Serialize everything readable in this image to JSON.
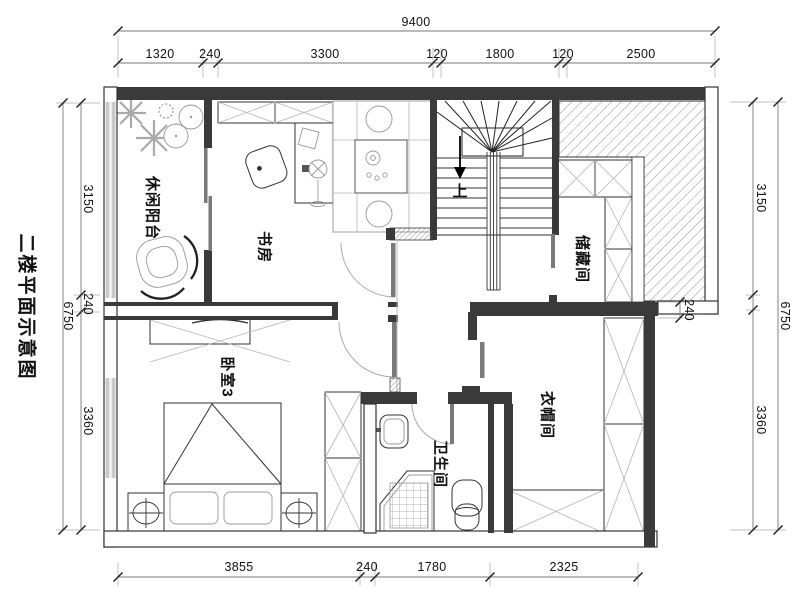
{
  "title": "二楼平面示意图",
  "rooms": {
    "balcony": "休闲阳台",
    "study": "书房",
    "storage": "储藏间",
    "bedroom": "卧室3",
    "closet": "衣帽间",
    "bathroom": "卫生间"
  },
  "stairs": {
    "direction_label": "上"
  },
  "dimensions": {
    "top_total": "9400",
    "top_segments": [
      "1320",
      "240",
      "3300",
      "120",
      "1800",
      "120",
      "2500"
    ],
    "left_total": "6750",
    "left_segments": [
      "3150",
      "240",
      "3360"
    ],
    "right_total": "6750",
    "right_segments": [
      "3150",
      "3360"
    ],
    "wall_thickness": "240",
    "bottom_segments": [
      "3855",
      "240",
      "1780",
      "2325"
    ]
  },
  "colors": {
    "wall": "#3a3a3a",
    "hatch": "#9a9a9a",
    "furniture": "#8a8a8a",
    "text": "#111111"
  }
}
